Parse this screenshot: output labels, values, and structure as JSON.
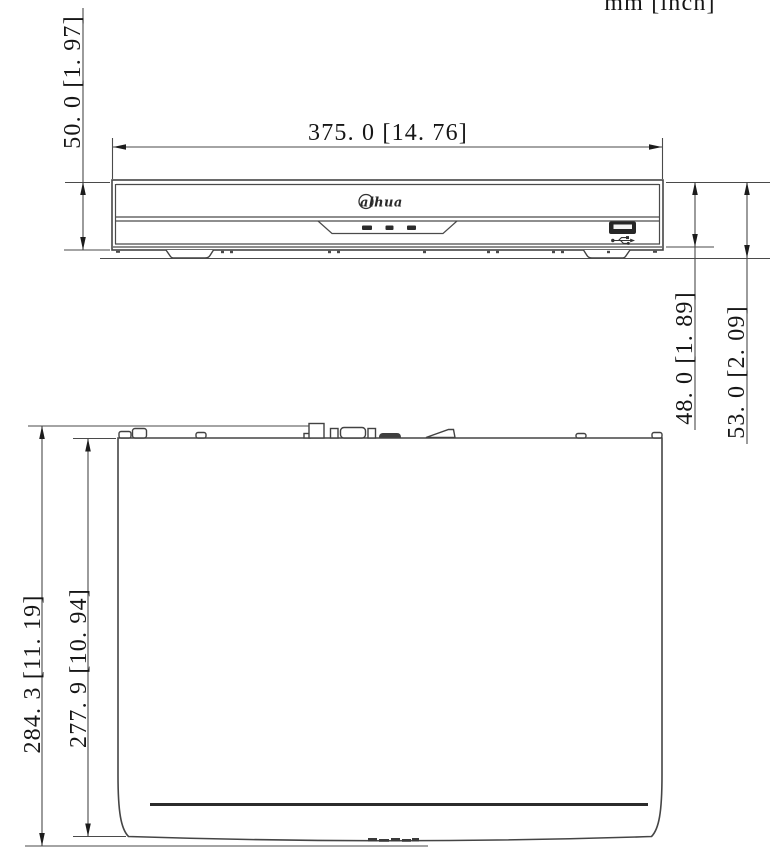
{
  "page": {
    "background": "#ffffff",
    "description": "Technical dimension drawing of NVR device, front view and top view"
  },
  "units": {
    "label": "mm [inch]"
  },
  "colors": {
    "line": "#4a4a4a",
    "dark": "#2c2c2c",
    "text": "#161616",
    "background": "#ffffff"
  },
  "front_view": {
    "logo_text": "alhua",
    "icons": {
      "usb": "usb-icon",
      "led": "led-indicator"
    },
    "dims": {
      "width": "375. 0  [14. 76]",
      "height_with_feet": "50. 0  [1. 97]",
      "body_height": "48. 0  [1. 89]",
      "overall_height": "53. 0  [2. 09]"
    }
  },
  "top_view": {
    "dims": {
      "overall_depth": "284. 3  [11. 19]",
      "body_depth": "277. 9  [10. 94]"
    }
  }
}
